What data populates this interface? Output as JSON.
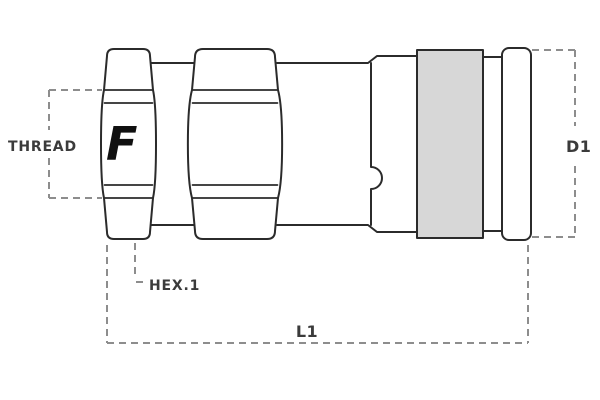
{
  "drawing": {
    "labels": {
      "thread": "THREAD",
      "hex": "HEX.1",
      "length": "L1",
      "diameter": "D1"
    },
    "logo_letter": "F",
    "colors": {
      "outline": "#2b2b2b",
      "dimension": "#8d8d8d",
      "sleeve_fill": "#d7d7d7",
      "label_text": "#3b3b3b",
      "logo": "#101010",
      "background": "#ffffff"
    }
  }
}
